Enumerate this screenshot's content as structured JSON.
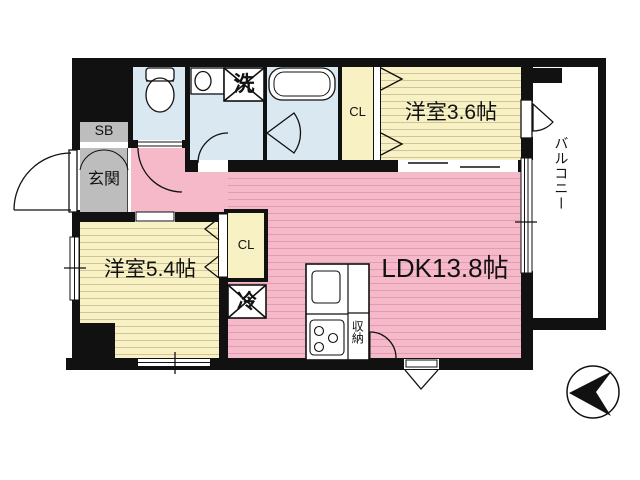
{
  "labels": {
    "ldk": "LDK13.8帖",
    "western_room_upper": "洋室3.6帖",
    "western_room_lower": "洋室5.4帖",
    "entrance": "玄関",
    "shoe_box": "SB",
    "closet_upper": "CL",
    "closet_lower": "CL",
    "washing_machine": "洗",
    "refrigerator": "冷",
    "storage": "収納",
    "balcony": "バルコニー"
  },
  "colors": {
    "wall": "#111111",
    "flooring_cream": "#f8f1c4",
    "flooring_cream_stripe": "#cfc49e",
    "ldk_pink": "#f6b9c9",
    "ldk_pink_stripe": "#e09cb2",
    "wet_area_blue": "#d9e8f1",
    "entrance_gray": "#bdbdbd"
  }
}
